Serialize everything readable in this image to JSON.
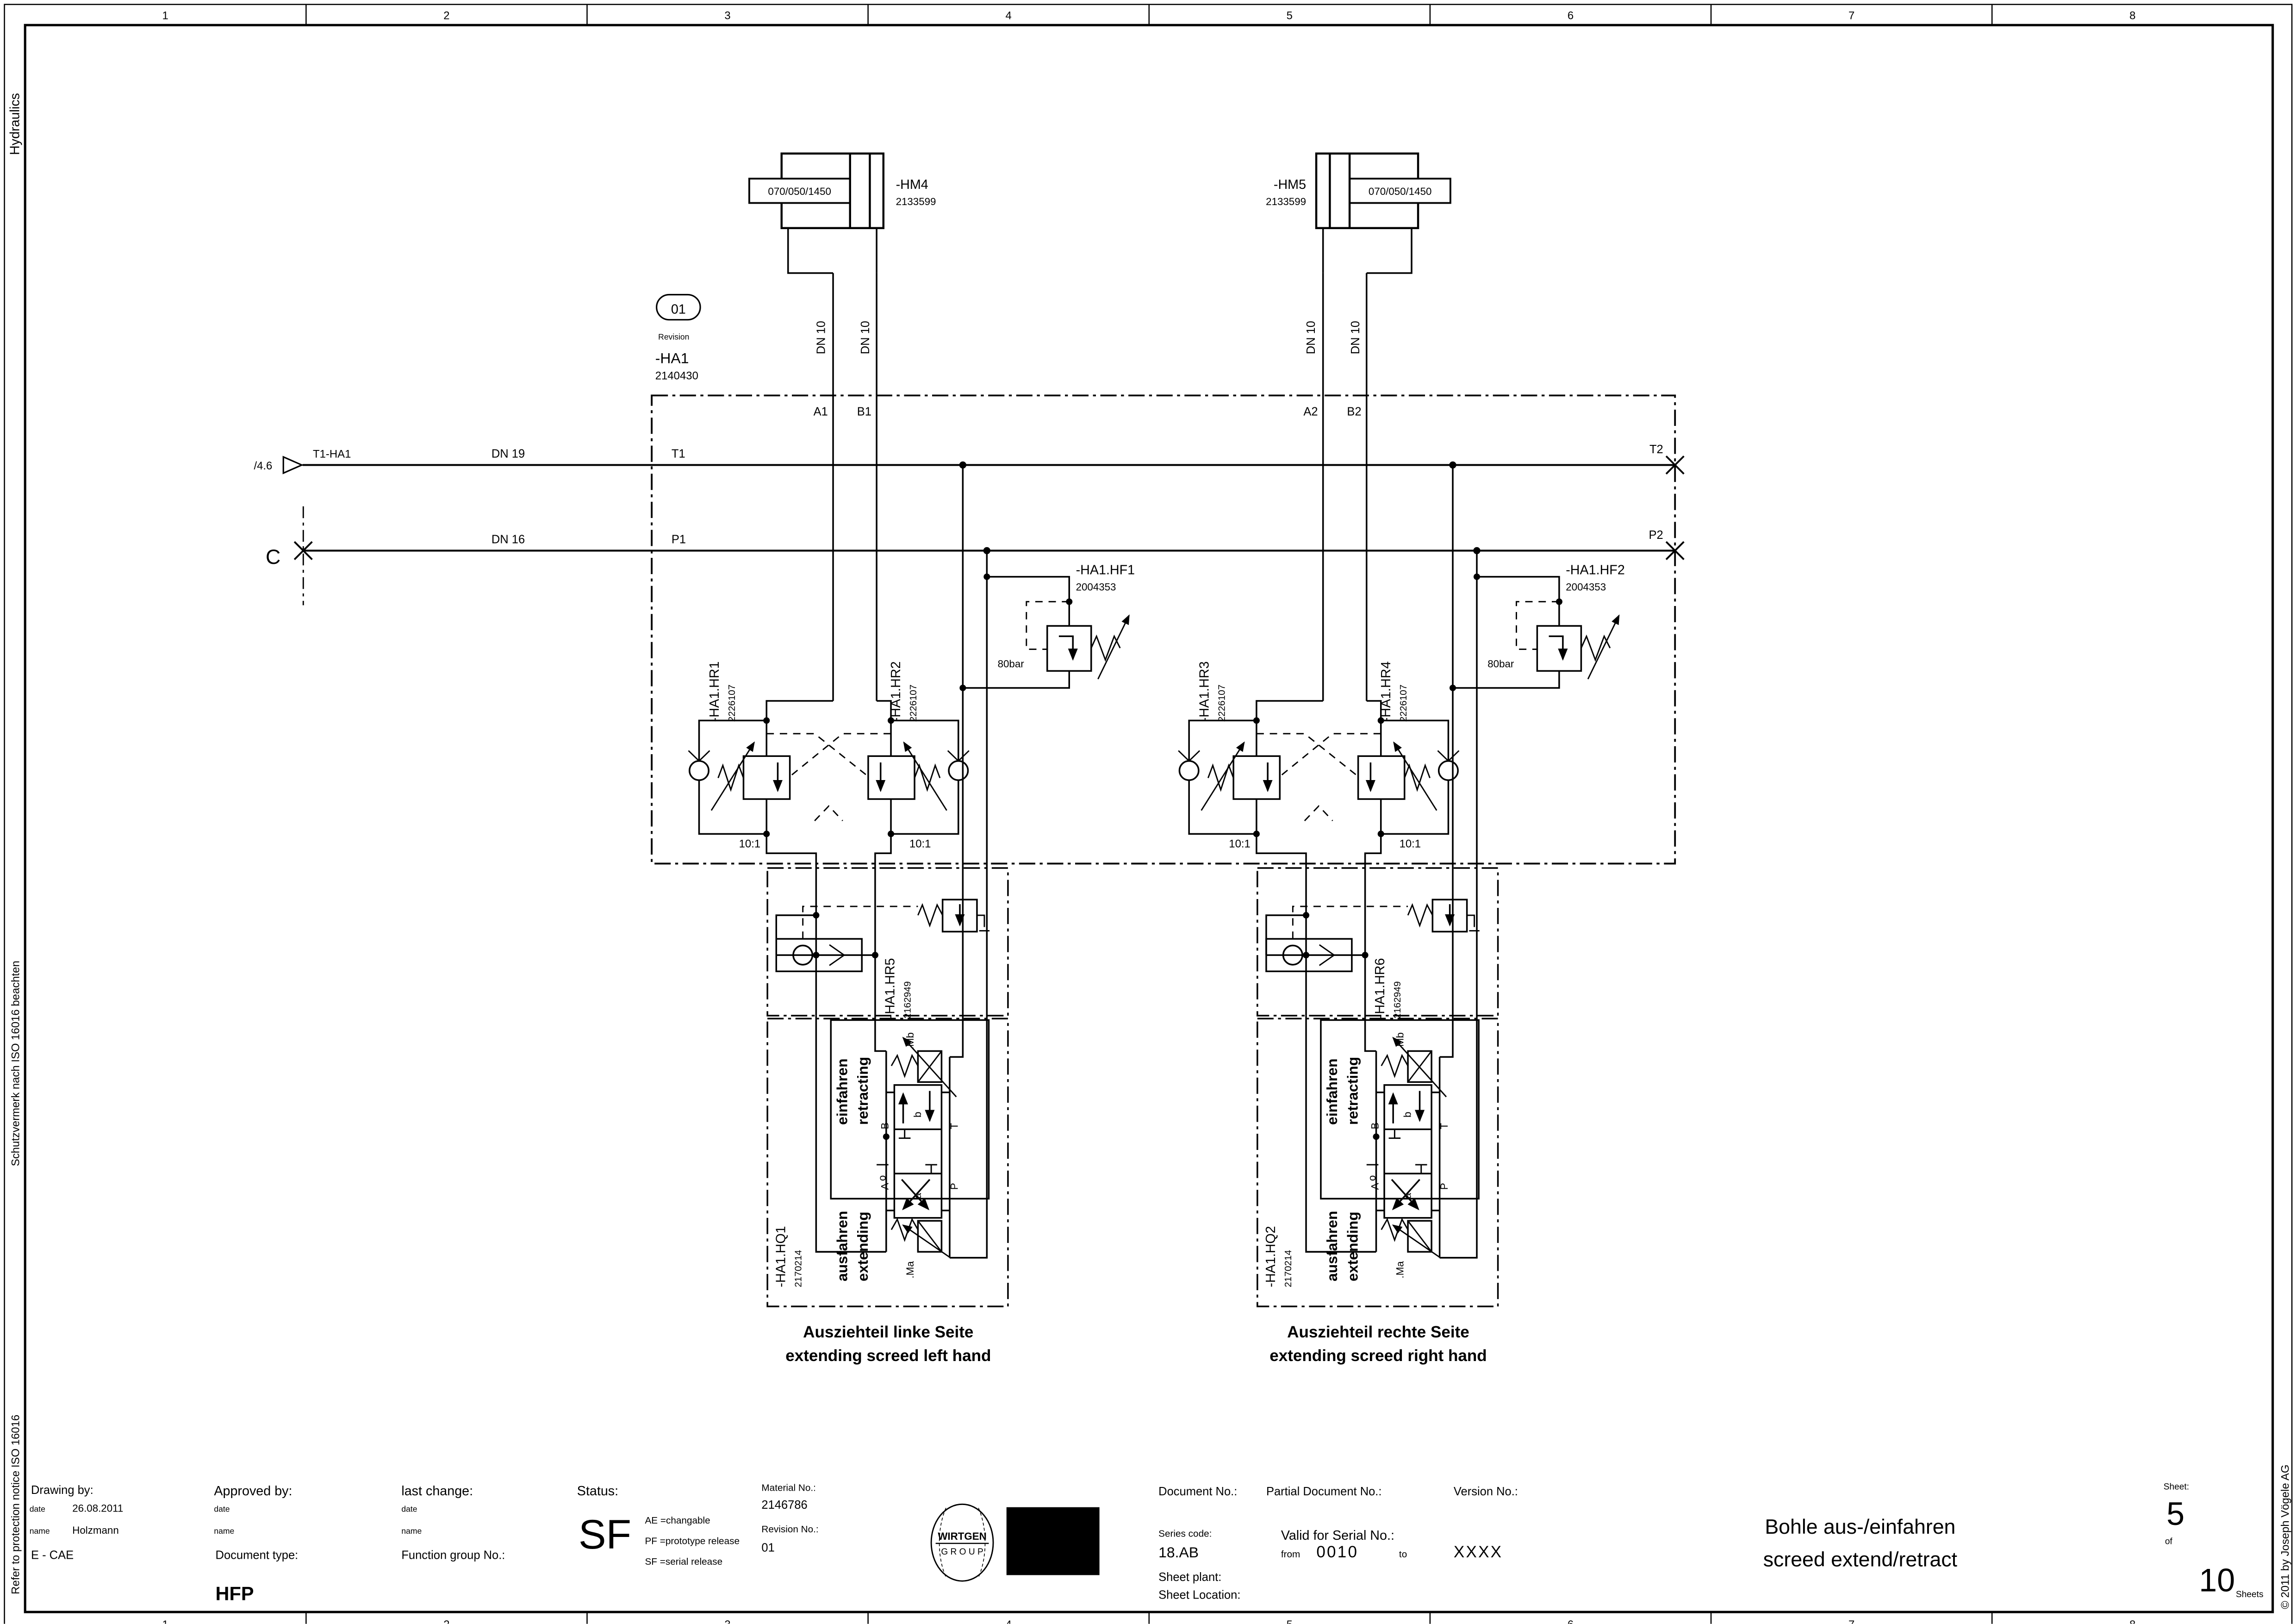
{
  "frame": {
    "grid_numbers": [
      "1",
      "2",
      "3",
      "4",
      "5",
      "6",
      "7",
      "8"
    ],
    "margins": {
      "discipline": "Hydraulics",
      "protect_de": "Schutzvermerk nach ISO 16016 beachten",
      "protect_en": "Refer to protection notice ISO 16016",
      "copyright": "© 2011 by Joseph Vögele AG"
    }
  },
  "schematic": {
    "revision": {
      "value": "01",
      "caption": "Revision"
    },
    "assembly": {
      "name": "-HA1",
      "part_no": "2140430"
    },
    "cylinders": [
      {
        "name": "-HM4",
        "part_no": "2133599",
        "size": "070/050/1450"
      },
      {
        "name": "-HM5",
        "part_no": "2133599",
        "size": "070/050/1450"
      }
    ],
    "tank_line": {
      "ref": "T1-HA1",
      "page_ref": "/4.6",
      "size": "DN 19",
      "port_left": "T1",
      "port_right": "T2"
    },
    "pressure_line": {
      "connector": "C",
      "size": "DN 16",
      "port_left": "P1",
      "port_right": "P2"
    },
    "hose_size": "DN 10",
    "circuits": [
      {
        "port_a": "A1",
        "port_b": "B1",
        "hf": {
          "name": "-HA1.HF1",
          "part_no": "2004353",
          "pressure": "80bar"
        },
        "hr_a": {
          "name": "-HA1.HR1",
          "part_no": "2226107",
          "ratio": "10:1"
        },
        "hr_b": {
          "name": "-HA1.HR2",
          "part_no": "2226107",
          "ratio": "10:1"
        },
        "check": {
          "name": "-HA1.HR5",
          "part_no": "2162949"
        },
        "hq": {
          "name": "-HA1.HQ1",
          "part_no": "2170214"
        },
        "caption_de": "Ausziehteil linke Seite",
        "caption_en": "extending screed left hand"
      },
      {
        "port_a": "A2",
        "port_b": "B2",
        "hf": {
          "name": "-HA1.HF2",
          "part_no": "2004353",
          "pressure": "80bar"
        },
        "hr_a": {
          "name": "-HA1.HR3",
          "part_no": "2226107",
          "ratio": "10:1"
        },
        "hr_b": {
          "name": "-HA1.HR4",
          "part_no": "2226107",
          "ratio": "10:1"
        },
        "check": {
          "name": "-HA1.HR6",
          "part_no": "2162949"
        },
        "hq": {
          "name": "-HA1.HQ2",
          "part_no": "2170214"
        },
        "caption_de": "Ausziehteil rechte Seite",
        "caption_en": "extending screed right hand"
      }
    ],
    "hq_common": {
      "retract_de": "einfahren",
      "retract_en": "retracting",
      "extend_de": "ausfahren",
      "extend_en": "extending",
      "sol_b": ".Mb",
      "sol_a": ".Ma",
      "pos_b": "b",
      "pos_o": "o",
      "pos_a": "a",
      "port_a": "A",
      "port_b": "B",
      "port_p": "P",
      "port_t": "T"
    }
  },
  "title_block": {
    "drawing_by": {
      "label": "Drawing by:",
      "date_label": "date",
      "date": "26.08.2011",
      "name_label": "name",
      "name": "Holzmann",
      "org": "E - CAE"
    },
    "approved_by": {
      "label": "Approved by:",
      "date_label": "date",
      "name_label": "name"
    },
    "last_change": {
      "label": "last change:",
      "date_label": "date",
      "name_label": "name"
    },
    "document_type": {
      "label": "Document type:",
      "value": "HFP"
    },
    "function_group": {
      "label": "Function group No.:"
    },
    "status": {
      "label": "Status:",
      "value": "SF",
      "legend": [
        "AE =changable",
        "PF =prototype release",
        "SF =serial release"
      ]
    },
    "material": {
      "label": "Material No.:",
      "value": "2146786",
      "revision_label": "Revision No.:",
      "revision": "01"
    },
    "logos": {
      "wirtgen_line1": "WIRTGEN",
      "wirtgen_line2": "G R O U P",
      "voegele": "VÖGELE"
    },
    "document": {
      "doc_label": "Document No.:",
      "partial_label": "Partial Document No.:",
      "version_label": "Version No.:"
    },
    "series": {
      "label": "Series code:",
      "value": "18.AB"
    },
    "serial": {
      "label": "Valid for Serial No.:",
      "from_label": "from",
      "from": "0010",
      "to_label": "to",
      "to": "XXXX"
    },
    "sheet_info": {
      "plant_label": "Sheet plant:",
      "location_label": "Sheet Location:"
    },
    "title": {
      "line1": "Bohle aus-/einfahren",
      "line2": "screed extend/retract"
    },
    "sheet": {
      "label": "Sheet:",
      "number": "5",
      "of": "of",
      "total": "10",
      "sheets": "Sheets"
    }
  }
}
